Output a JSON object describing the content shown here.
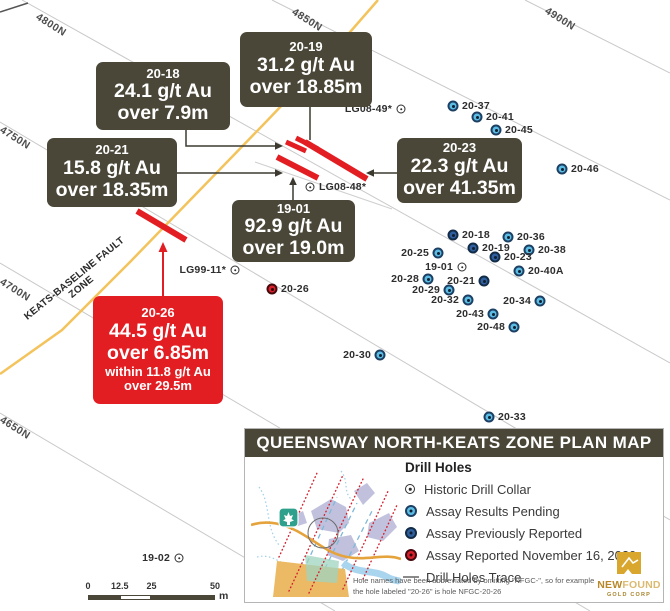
{
  "colors": {
    "box_olive": "#4a4738",
    "accent_red": "#e31e23",
    "fault_yellow": "#f3c35c",
    "pending_blue": "#5bbde4",
    "reported_blue": "#2f5f9e",
    "gridline_gray": "#c9c9c9",
    "logo_gold": "#c9992e"
  },
  "grid": {
    "labels": [
      {
        "text": "4800N",
        "x": 40,
        "y": 11
      },
      {
        "text": "4850N",
        "x": 296,
        "y": 6
      },
      {
        "text": "4900N",
        "x": 549,
        "y": 5
      },
      {
        "text": "4750N",
        "x": 4,
        "y": 124
      },
      {
        "text": "4700N",
        "x": 4,
        "y": 276
      },
      {
        "text": "4650N",
        "x": 4,
        "y": 414
      }
    ]
  },
  "fault": {
    "label": "KEATS-BASELINE FAULT ZONE"
  },
  "callouts": [
    {
      "id": "20-18",
      "variant": "olive",
      "x": 96,
      "y": 62,
      "w": 134,
      "h": 68,
      "lines": [
        [
          "title",
          "20-18"
        ],
        [
          "big",
          "24.1 g/t Au"
        ],
        [
          "big",
          "over 7.9m"
        ]
      ]
    },
    {
      "id": "20-19",
      "variant": "olive",
      "x": 240,
      "y": 32,
      "w": 132,
      "h": 75,
      "lines": [
        [
          "title",
          "20-19"
        ],
        [
          "big",
          "31.2 g/t Au"
        ],
        [
          "big",
          "over 18.85m"
        ]
      ]
    },
    {
      "id": "20-21",
      "variant": "olive",
      "x": 47,
      "y": 138,
      "w": 130,
      "h": 69,
      "lines": [
        [
          "title",
          "20-21"
        ],
        [
          "big",
          "15.8 g/t Au"
        ],
        [
          "big",
          "over 18.35m"
        ]
      ]
    },
    {
      "id": "20-23",
      "variant": "olive",
      "x": 397,
      "y": 138,
      "w": 125,
      "h": 65,
      "lines": [
        [
          "title",
          "20-23"
        ],
        [
          "big",
          "22.3 g/t Au"
        ],
        [
          "big",
          "over 41.35m"
        ]
      ]
    },
    {
      "id": "19-01",
      "variant": "olive",
      "x": 232,
      "y": 200,
      "w": 123,
      "h": 62,
      "lines": [
        [
          "title",
          "19-01"
        ],
        [
          "big",
          "92.9 g/t Au"
        ],
        [
          "big",
          "over 19.0m"
        ]
      ]
    },
    {
      "id": "20-26",
      "variant": "red",
      "x": 93,
      "y": 296,
      "w": 130,
      "h": 108,
      "lines": [
        [
          "title",
          "20-26"
        ],
        [
          "big",
          "44.5 g/t Au"
        ],
        [
          "big",
          "over 6.85m"
        ],
        [
          "small",
          "within 11.8 g/t Au"
        ],
        [
          "small",
          "over 29.5m"
        ]
      ]
    }
  ],
  "holes": [
    {
      "label": "20-37",
      "x": 453,
      "y": 106,
      "type": "pending",
      "side": "right"
    },
    {
      "label": "20-41",
      "x": 477,
      "y": 117,
      "type": "pending",
      "side": "right"
    },
    {
      "label": "20-45",
      "x": 496,
      "y": 130,
      "type": "pending",
      "side": "right"
    },
    {
      "label": "20-46",
      "x": 562,
      "y": 169,
      "type": "pending",
      "side": "right"
    },
    {
      "label": "20-18",
      "x": 453,
      "y": 235,
      "type": "reported",
      "side": "right"
    },
    {
      "label": "20-36",
      "x": 508,
      "y": 237,
      "type": "pending",
      "side": "right"
    },
    {
      "label": "20-19",
      "x": 473,
      "y": 248,
      "type": "reported",
      "side": "right"
    },
    {
      "label": "20-38",
      "x": 529,
      "y": 250,
      "type": "pending",
      "side": "right"
    },
    {
      "label": "20-25",
      "x": 438,
      "y": 253,
      "type": "pending",
      "side": "left"
    },
    {
      "label": "20-23",
      "x": 495,
      "y": 257,
      "type": "reported",
      "side": "right"
    },
    {
      "label": "19-01",
      "x": 462,
      "y": 267,
      "type": "historic",
      "side": "left"
    },
    {
      "label": "20-40A",
      "x": 519,
      "y": 271,
      "type": "pending",
      "side": "right"
    },
    {
      "label": "20-28",
      "x": 428,
      "y": 279,
      "type": "pending",
      "side": "left"
    },
    {
      "label": "20-21",
      "x": 484,
      "y": 281,
      "type": "reported",
      "side": "left"
    },
    {
      "label": "20-29",
      "x": 449,
      "y": 290,
      "type": "pending",
      "side": "left"
    },
    {
      "label": "20-32",
      "x": 468,
      "y": 300,
      "type": "pending",
      "side": "left"
    },
    {
      "label": "20-34",
      "x": 540,
      "y": 301,
      "type": "pending",
      "side": "left"
    },
    {
      "label": "20-43",
      "x": 493,
      "y": 314,
      "type": "pending",
      "side": "left"
    },
    {
      "label": "20-48",
      "x": 514,
      "y": 327,
      "type": "pending",
      "side": "left"
    },
    {
      "label": "20-30",
      "x": 380,
      "y": 355,
      "type": "pending",
      "side": "left"
    },
    {
      "label": "20-33",
      "x": 489,
      "y": 417,
      "type": "pending",
      "side": "right"
    },
    {
      "label": "20-26",
      "x": 272,
      "y": 289,
      "type": "nov16",
      "side": "right"
    },
    {
      "label": "LG08-49*",
      "x": 401,
      "y": 109,
      "type": "historic",
      "side": "left"
    },
    {
      "label": "LG08-48*",
      "x": 310,
      "y": 187,
      "type": "historic",
      "side": "right"
    },
    {
      "label": "LG99-11*",
      "x": 235,
      "y": 270,
      "type": "historic",
      "side": "left"
    },
    {
      "label": "19-02",
      "x": 179,
      "y": 558,
      "type": "historic",
      "side": "left"
    }
  ],
  "legend": {
    "title": "QUEENSWAY NORTH-KEATS ZONE PLAN MAP",
    "header": "Drill Holes",
    "items": [
      {
        "type": "historic",
        "label": "Historic Drill Collar"
      },
      {
        "type": "pending",
        "label": "Assay Results Pending"
      },
      {
        "type": "reported",
        "label": "Assay Previously Reported"
      },
      {
        "type": "nov16",
        "label": "Assay Reported November 16, 2020"
      },
      {
        "type": "trace",
        "label": "Drill Holes Trace"
      }
    ],
    "note_line1": "Hole names have been abbreviated by omitting \"NFGC-\", so for example",
    "note_line2": "the hole labeled \"20-26\" is hole NFGC-20-26",
    "logo": {
      "new": "NEW",
      "found": "FOUND",
      "sub": "GOLD CORP"
    }
  },
  "scalebar": {
    "ticks": [
      "0",
      "12.5",
      "25",
      "50"
    ],
    "max": 50,
    "unit": "m"
  }
}
